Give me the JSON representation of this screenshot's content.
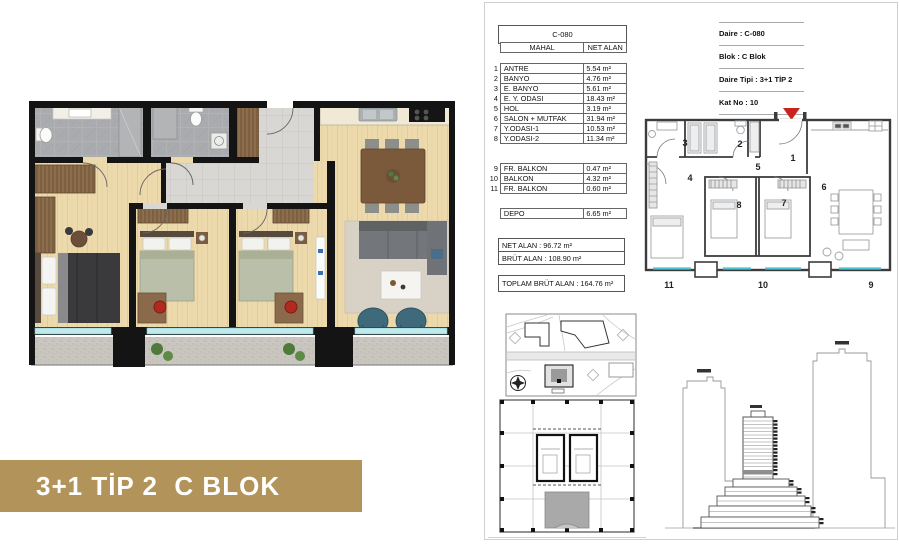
{
  "banner": {
    "title": "3+1 TİP 2  C BLOK"
  },
  "unit_table": {
    "header": "C-080",
    "columns": [
      "MAHAL",
      "NET ALAN"
    ],
    "rows": [
      {
        "no": "1",
        "name": "ANTRE",
        "area": "5.54 m²"
      },
      {
        "no": "2",
        "name": "BANYO",
        "area": "4.76 m²"
      },
      {
        "no": "3",
        "name": "E. BANYO",
        "area": "5.61 m²"
      },
      {
        "no": "4",
        "name": "E. Y. ODASI",
        "area": "18.43 m²"
      },
      {
        "no": "5",
        "name": "HOL",
        "area": "3.19 m²"
      },
      {
        "no": "6",
        "name": "SALON + MUTFAK",
        "area": "31.94 m²"
      },
      {
        "no": "7",
        "name": "Y.ODASI-1",
        "area": "10.53 m²"
      },
      {
        "no": "8",
        "name": "Y.ODASI-2",
        "area": "11.34 m²"
      },
      {
        "no": "9",
        "name": "FR. BALKON",
        "area": "0.47 m²"
      },
      {
        "no": "10",
        "name": "BALKON",
        "area": "4.32 m²"
      },
      {
        "no": "11",
        "name": "FR. BALKON",
        "area": "0.60 m²"
      },
      {
        "no": "",
        "name": "DEPO",
        "area": "6.65 m²"
      }
    ],
    "net_total": "NET ALAN : 96.72 m²",
    "brut_total": "BRÜT ALAN : 108.90 m²",
    "grand_total": "TOPLAM BRÜT ALAN : 164.76 m²"
  },
  "info_box": {
    "rows": [
      "Daire : C-080",
      "Blok : C Blok",
      "Daire Tipi : 3+1 TİP 2",
      "Kat No : 10"
    ]
  },
  "key_plan": {
    "rooms": [
      "1",
      "2",
      "3",
      "4",
      "5",
      "6",
      "7",
      "8"
    ],
    "balcony_labels": [
      "11",
      "10",
      "9"
    ]
  },
  "colors": {
    "banner_gold": "#b2945a",
    "wall_black": "#141414",
    "wood_floor": "#ecd9ac",
    "bath_tile": "#a9abae",
    "corridor_tile": "#d8d7d4",
    "balcony_stone": "#c9c6c0",
    "window_cyan": "#bfe9ec",
    "marker_red": "#c8231f",
    "armchair_teal": "#3f6a7c",
    "bed_olive": "#b9bfa8"
  }
}
